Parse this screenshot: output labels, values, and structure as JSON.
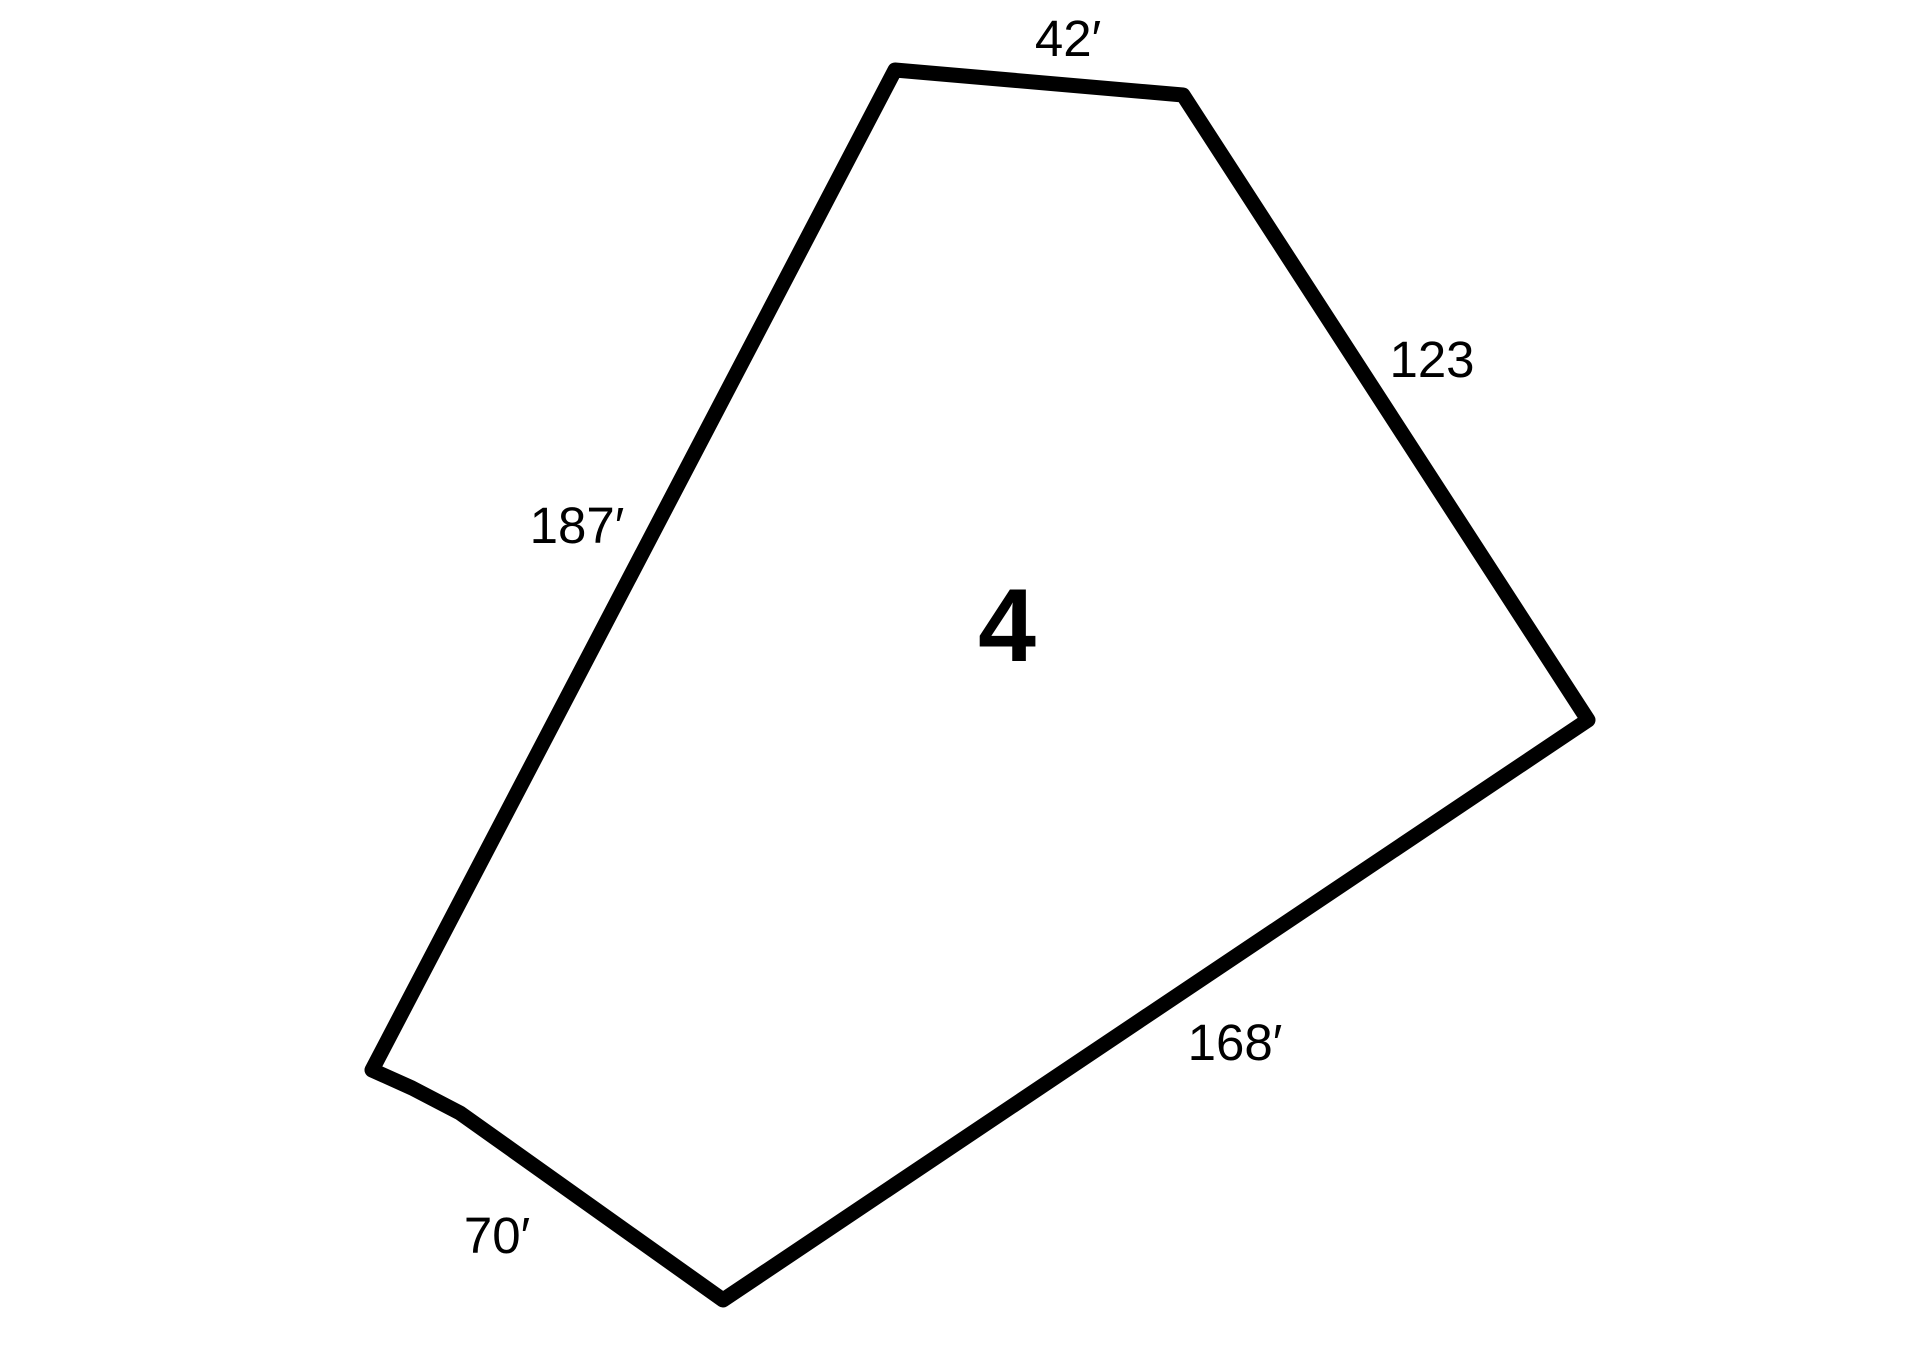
{
  "figure": {
    "type": "parcel-outline-diagram",
    "background_color": "#ffffff",
    "line_color": "#000000",
    "line_width": 15,
    "parcel_number": "4",
    "parcel_number_pos": {
      "x": 1007,
      "y": 661
    },
    "outline_vertices": [
      [
        895,
        70
      ],
      [
        1183,
        95
      ],
      [
        1588,
        720
      ],
      [
        723,
        1300
      ],
      [
        460,
        1113
      ],
      [
        412,
        1088
      ],
      [
        372,
        1070
      ]
    ],
    "side_labels": [
      {
        "side": "top",
        "text": "42′",
        "x": 1068,
        "y": 56
      },
      {
        "side": "upper-right",
        "text": "123",
        "x": 1432,
        "y": 377
      },
      {
        "side": "lower-right",
        "text": "168′",
        "x": 1235,
        "y": 1060
      },
      {
        "side": "lower-left",
        "text": "70′",
        "x": 497,
        "y": 1253
      },
      {
        "side": "left",
        "text": "187′",
        "x": 577,
        "y": 543
      }
    ]
  }
}
